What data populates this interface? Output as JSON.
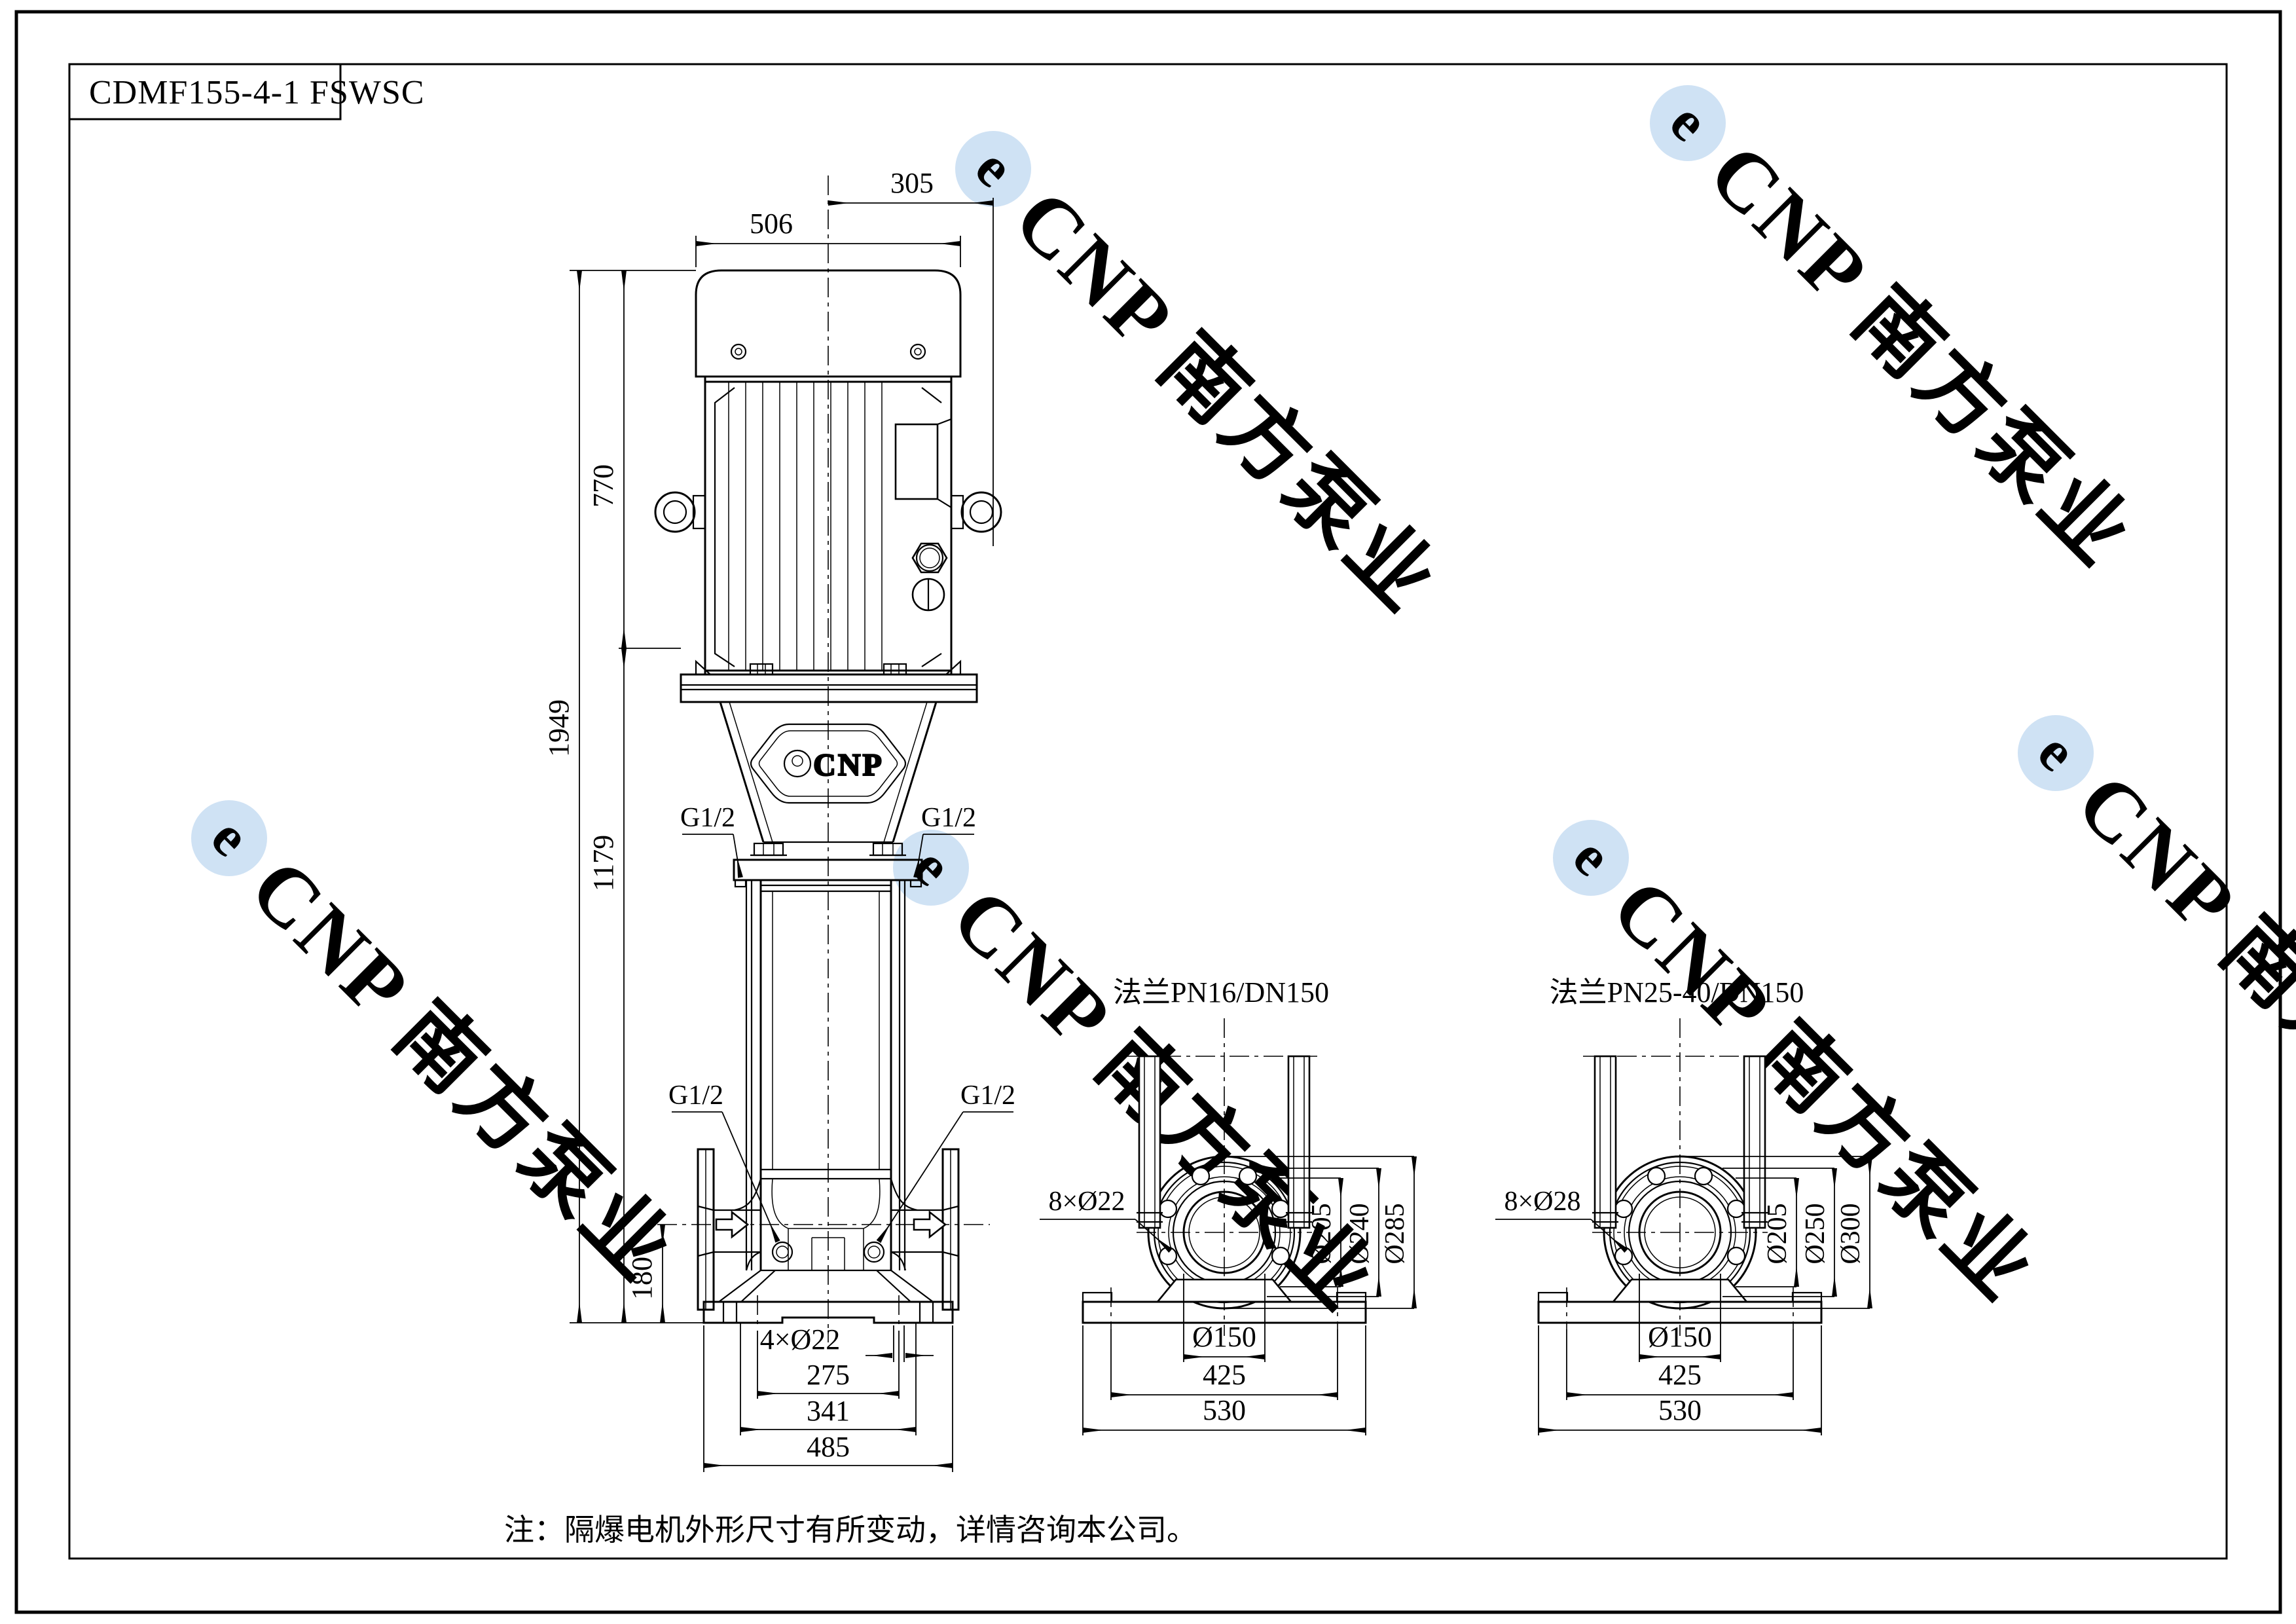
{
  "page": {
    "title": "CDMF155-4-1 FSWSC",
    "note": "注：隔爆电机外形尺寸有所变动，详情咨询本公司。"
  },
  "watermark": {
    "text": "CNP 南方泵业",
    "logo_letter": "e",
    "text_color": "#dde5ef",
    "logo_color": "#cfe2f4"
  },
  "badge": {
    "text": "CNP"
  },
  "main_view": {
    "dims": {
      "motor_width": "506",
      "center_offset": "305",
      "motor_height": "770",
      "total_height": "1949",
      "pump_height": "1179",
      "port_height": "180",
      "base_holes": "4×Ø22",
      "hole_span": "275",
      "mid_span": "341",
      "base_width": "485"
    },
    "ports": {
      "vent_left": "G1/2",
      "vent_right": "G1/2",
      "drain_left": "G1/2",
      "drain_right": "G1/2"
    }
  },
  "flange_pn16": {
    "title": "法兰PN16/DN150",
    "holes": "8×Ø22",
    "d_face": "Ø205",
    "d_bolt": "Ø240",
    "d_outer": "Ø285",
    "bore": "Ø150",
    "hole_span": "425",
    "base_width": "530"
  },
  "flange_pn25": {
    "title": "法兰PN25-40/DN150",
    "holes": "8×Ø28",
    "d_face": "Ø205",
    "d_bolt": "Ø250",
    "d_outer": "Ø300",
    "bore": "Ø150",
    "hole_span": "425",
    "base_width": "530"
  }
}
